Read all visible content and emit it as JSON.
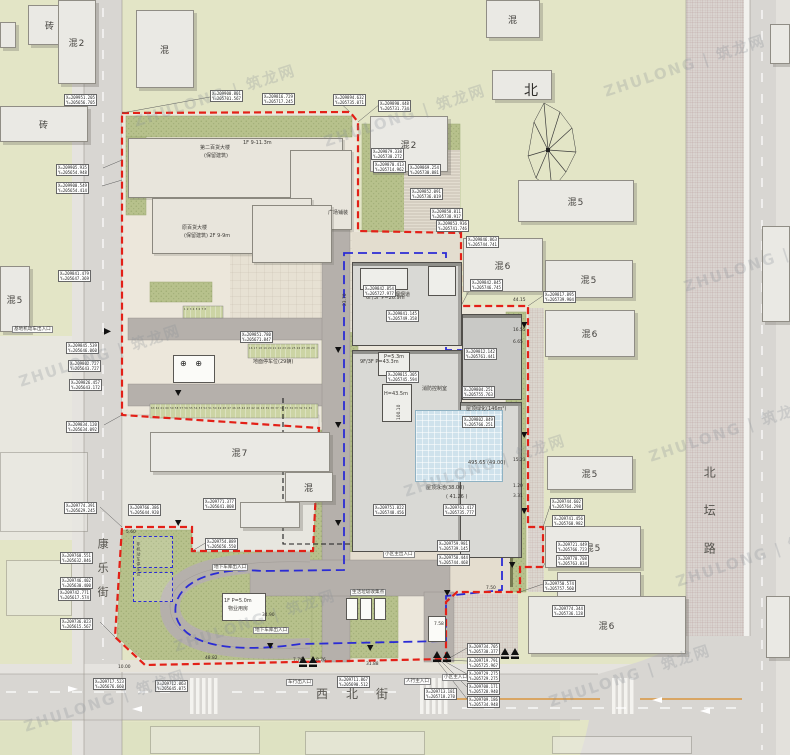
{
  "palette": {
    "boundary_red": "#E32017",
    "garage_blue": "#2B2BD5",
    "site_green": "#B7C18C",
    "road_gray": "#D8D6D2",
    "pool_blue": "#CFE2EC",
    "lawn": "#E3E5C6"
  },
  "compass": {
    "label": "北"
  },
  "streets": {
    "west": "康乐街",
    "south": "西北街",
    "east": "北坛路"
  },
  "watermarks": [
    {
      "x": 130,
      "y": 85,
      "t": "ZHULONG | 筑龙网"
    },
    {
      "x": 15,
      "y": 345,
      "t": "ZHULONG | 筑龙网"
    },
    {
      "x": 400,
      "y": 455,
      "t": "ZHULONG | 筑龙网"
    },
    {
      "x": 600,
      "y": 55,
      "t": "ZHULONG | 筑龙网"
    },
    {
      "x": 645,
      "y": 420,
      "t": "ZHULONG | 筑龙网"
    },
    {
      "x": 170,
      "y": 610,
      "t": "ZHULONG | 筑龙网"
    },
    {
      "x": 545,
      "y": 665,
      "t": "ZHULONG | 筑龙网"
    },
    {
      "x": 20,
      "y": 690,
      "t": "ZHULONG | 筑龙网"
    },
    {
      "x": 680,
      "y": 250,
      "t": "ZHULONG | 筑龙网"
    },
    {
      "x": 672,
      "y": 545,
      "t": "ZHULONG | 筑龙网"
    },
    {
      "x": 320,
      "y": 105,
      "t": "ZHULONG | 筑龙网"
    }
  ],
  "buildings": [
    {
      "x": 28,
      "y": 5,
      "w": 44,
      "h": 40,
      "label": "砖"
    },
    {
      "x": 58,
      "y": 0,
      "w": 38,
      "h": 84,
      "label": "混2"
    },
    {
      "x": 136,
      "y": 10,
      "w": 58,
      "h": 78,
      "label": "混"
    },
    {
      "x": 0,
      "y": 22,
      "w": 16,
      "h": 26,
      "label": ""
    },
    {
      "x": 0,
      "y": 106,
      "w": 88,
      "h": 36,
      "label": "砖"
    },
    {
      "x": 0,
      "y": 266,
      "w": 30,
      "h": 66,
      "label": "混5"
    },
    {
      "x": 0,
      "y": 452,
      "w": 88,
      "h": 80,
      "label": "",
      "cls": "faint"
    },
    {
      "x": 6,
      "y": 560,
      "w": 66,
      "h": 56,
      "label": "",
      "cls": "faint"
    },
    {
      "x": 486,
      "y": 0,
      "w": 54,
      "h": 38,
      "label": "混"
    },
    {
      "x": 370,
      "y": 116,
      "w": 78,
      "h": 56,
      "label": "混2"
    },
    {
      "x": 492,
      "y": 70,
      "w": 60,
      "h": 30,
      "label": ""
    },
    {
      "x": 518,
      "y": 180,
      "w": 116,
      "h": 42,
      "label": "混5"
    },
    {
      "x": 463,
      "y": 238,
      "w": 80,
      "h": 54,
      "label": "混6"
    },
    {
      "x": 545,
      "y": 260,
      "w": 88,
      "h": 38,
      "label": "混5"
    },
    {
      "x": 545,
      "y": 310,
      "w": 90,
      "h": 47,
      "label": "混6"
    },
    {
      "x": 547,
      "y": 456,
      "w": 86,
      "h": 34,
      "label": "混5"
    },
    {
      "x": 545,
      "y": 526,
      "w": 96,
      "h": 42,
      "label": "混5"
    },
    {
      "x": 557,
      "y": 572,
      "w": 84,
      "h": 26,
      "label": ""
    },
    {
      "x": 528,
      "y": 596,
      "w": 158,
      "h": 58,
      "label": "混6"
    },
    {
      "x": 770,
      "y": 24,
      "w": 20,
      "h": 40,
      "label": ""
    },
    {
      "x": 762,
      "y": 226,
      "w": 28,
      "h": 96,
      "label": ""
    },
    {
      "x": 766,
      "y": 596,
      "w": 24,
      "h": 62,
      "label": ""
    },
    {
      "x": 150,
      "y": 726,
      "w": 110,
      "h": 28,
      "label": "",
      "cls": "faint"
    },
    {
      "x": 305,
      "y": 731,
      "w": 120,
      "h": 24,
      "label": "",
      "cls": "faint"
    },
    {
      "x": 552,
      "y": 736,
      "w": 140,
      "h": 18,
      "label": "",
      "cls": "faint"
    },
    {
      "x": 150,
      "y": 432,
      "w": 180,
      "h": 40,
      "label": "混7"
    },
    {
      "x": 285,
      "y": 472,
      "w": 48,
      "h": 30,
      "label": "混"
    },
    {
      "x": 240,
      "y": 502,
      "w": 60,
      "h": 26,
      "label": ""
    },
    {
      "x": 128,
      "y": 138,
      "w": 215,
      "h": 60,
      "label": "",
      "cls": "retained"
    },
    {
      "x": 290,
      "y": 150,
      "w": 62,
      "h": 80,
      "label": "",
      "cls": "retained"
    },
    {
      "x": 152,
      "y": 198,
      "w": 160,
      "h": 56,
      "label": "",
      "cls": "retained"
    },
    {
      "x": 252,
      "y": 205,
      "w": 80,
      "h": 58,
      "label": "",
      "cls": "retained"
    },
    {
      "x": 352,
      "y": 262,
      "w": 110,
      "h": 84,
      "label": "",
      "cls": "new"
    },
    {
      "x": 352,
      "y": 350,
      "w": 110,
      "h": 202,
      "label": "",
      "cls": "new"
    },
    {
      "x": 462,
      "y": 314,
      "w": 60,
      "h": 86,
      "label": "",
      "cls": "newdark"
    },
    {
      "x": 460,
      "y": 402,
      "w": 62,
      "h": 156,
      "label": "",
      "cls": "new"
    },
    {
      "x": 360,
      "y": 268,
      "w": 48,
      "h": 22,
      "label": "",
      "cls": "roofbox"
    },
    {
      "x": 428,
      "y": 266,
      "w": 28,
      "h": 30,
      "label": "",
      "cls": "roofbox"
    },
    {
      "x": 378,
      "y": 352,
      "w": 32,
      "h": 24,
      "label": "",
      "cls": "roofbox"
    },
    {
      "x": 382,
      "y": 384,
      "w": 30,
      "h": 38,
      "label": "",
      "cls": "roofbox"
    },
    {
      "x": 415,
      "y": 410,
      "w": 88,
      "h": 72,
      "label": "",
      "cls": "pool"
    },
    {
      "x": 173,
      "y": 355,
      "w": 42,
      "h": 28,
      "label": "",
      "cls": "white"
    },
    {
      "x": 222,
      "y": 593,
      "w": 44,
      "h": 28,
      "label": "",
      "cls": "white"
    },
    {
      "x": 346,
      "y": 598,
      "w": 12,
      "h": 22,
      "label": "",
      "cls": "white"
    },
    {
      "x": 360,
      "y": 598,
      "w": 12,
      "h": 22,
      "label": "",
      "cls": "white"
    },
    {
      "x": 374,
      "y": 598,
      "w": 12,
      "h": 22,
      "label": "",
      "cls": "white"
    },
    {
      "x": 428,
      "y": 616,
      "w": 18,
      "h": 26,
      "label": "",
      "cls": "white"
    },
    {
      "x": 133,
      "y": 536,
      "w": 40,
      "h": 32,
      "label": "",
      "cls": "bike"
    },
    {
      "x": 133,
      "y": 572,
      "w": 40,
      "h": 30,
      "label": "",
      "cls": "bike"
    }
  ],
  "texts": [
    {
      "x": 96,
      "y": 538,
      "t": "康乐街",
      "cls": "vstreet"
    },
    {
      "x": 316,
      "y": 688,
      "t": "西北街",
      "cls": "hstreet"
    },
    {
      "x": 702,
      "y": 466,
      "t": "北坛路",
      "cls": "vstreet2"
    },
    {
      "x": 524,
      "y": 84,
      "t": "北",
      "cls": "north"
    },
    {
      "x": 200,
      "y": 146,
      "t": "第二百货大楼"
    },
    {
      "x": 204,
      "y": 154,
      "t": "(保留建筑)"
    },
    {
      "x": 243,
      "y": 141,
      "t": "1F 9-11.3m"
    },
    {
      "x": 182,
      "y": 226,
      "t": "原百货大楼"
    },
    {
      "x": 184,
      "y": 234,
      "t": "(保留建筑) 2F 9-9m"
    },
    {
      "x": 366,
      "y": 296,
      "t": "6F/3F  P=26.9m"
    },
    {
      "x": 360,
      "y": 360,
      "t": "9F/3F  P=43.3m"
    },
    {
      "x": 384,
      "y": 392,
      "t": "H=43.5m"
    },
    {
      "x": 384,
      "y": 355,
      "t": "P=5.3m"
    },
    {
      "x": 398,
      "y": 420,
      "t": "100.10",
      "cls": "dimv"
    },
    {
      "x": 344,
      "y": 306,
      "t": "23.70",
      "cls": "dimv"
    },
    {
      "x": 390,
      "y": 293,
      "t": "排烟烟道"
    },
    {
      "x": 422,
      "y": 387,
      "t": "消防控制室"
    },
    {
      "x": 466,
      "y": 407,
      "t": "屋顶绿化(146m²)"
    },
    {
      "x": 426,
      "y": 486,
      "t": "屋顶泳池(38.00)"
    },
    {
      "x": 446,
      "y": 495,
      "t": "( 41.26 )"
    },
    {
      "x": 468,
      "y": 461,
      "t": "495.65 (49.00)"
    },
    {
      "x": 328,
      "y": 211,
      "t": "广场铺装"
    },
    {
      "x": 253,
      "y": 360,
      "t": "地面停车位(29辆)"
    },
    {
      "x": 212,
      "y": 564,
      "t": "地下车库出入口",
      "cls": "tag"
    },
    {
      "x": 253,
      "y": 627,
      "t": "地下车库出入口",
      "cls": "tag"
    },
    {
      "x": 350,
      "y": 589,
      "t": "生活垃圾收集点",
      "cls": "tag"
    },
    {
      "x": 383,
      "y": 551,
      "t": "小区主出入口",
      "cls": "tag"
    },
    {
      "x": 286,
      "y": 679,
      "t": "车行出入口",
      "cls": "tag"
    },
    {
      "x": 404,
      "y": 678,
      "t": "人行主入口",
      "cls": "tag"
    },
    {
      "x": 442,
      "y": 674,
      "t": "小区主入口",
      "cls": "tag"
    },
    {
      "x": 12,
      "y": 326,
      "t": "基地机动车出入口",
      "cls": "tag"
    },
    {
      "x": 224,
      "y": 599,
      "t": "1F P=5.0m"
    },
    {
      "x": 228,
      "y": 607,
      "t": "物业用房"
    },
    {
      "x": 136,
      "y": 542,
      "t": "非机动车停车位",
      "cls": "vtiny"
    },
    {
      "x": 180,
      "y": 360,
      "t": "⊕ ⊕",
      "cls": "sym"
    },
    {
      "x": 249,
      "y": 347,
      "t": "16 17 18 19 20 21 22 23 24 25 26 27 28 29",
      "cls": "stall"
    },
    {
      "x": 151,
      "y": 407,
      "t": "63 62 61 60 59 58 57 56 55 54 53 52 51 50 49 48 47 46 45 44 43 42 41 40 39 38 37 36 35 34 33 32 31 30",
      "cls": "stall"
    },
    {
      "x": 184,
      "y": 308,
      "t": "1 2 3 4 5 6 7 8",
      "cls": "stall"
    },
    {
      "x": 118,
      "y": 666,
      "t": "10.00",
      "cls": "dim"
    },
    {
      "x": 205,
      "y": 657,
      "t": "48.82",
      "cls": "dim"
    },
    {
      "x": 293,
      "y": 659,
      "t": "7.70",
      "cls": "dim"
    },
    {
      "x": 316,
      "y": 659,
      "t": "8.76",
      "cls": "dim"
    },
    {
      "x": 366,
      "y": 663,
      "t": "31.88",
      "cls": "dim"
    },
    {
      "x": 262,
      "y": 614,
      "t": "34.90",
      "cls": "dim"
    },
    {
      "x": 434,
      "y": 623,
      "t": "7.58",
      "cls": "dim"
    },
    {
      "x": 126,
      "y": 531,
      "t": "5.60",
      "cls": "dim"
    },
    {
      "x": 486,
      "y": 587,
      "t": "7.50",
      "cls": "dim"
    },
    {
      "x": 513,
      "y": 299,
      "t": "44.15",
      "cls": "dim"
    },
    {
      "x": 513,
      "y": 329,
      "t": "16.55",
      "cls": "dim"
    },
    {
      "x": 513,
      "y": 341,
      "t": "6.65",
      "cls": "dim"
    },
    {
      "x": 513,
      "y": 459,
      "t": "15.23",
      "cls": "dim"
    },
    {
      "x": 513,
      "y": 485,
      "t": "1.20",
      "cls": "dim"
    },
    {
      "x": 513,
      "y": 495,
      "t": "3.31",
      "cls": "dim"
    }
  ],
  "coord_labels": [
    {
      "x": 64,
      "y": 94,
      "l1": "X=209951.205",
      "l2": "Y=205656.705"
    },
    {
      "x": 56,
      "y": 164,
      "l1": "X=209905.935",
      "l2": "Y=205654.948"
    },
    {
      "x": 56,
      "y": 182,
      "l1": "X=209900.549",
      "l2": "Y=205654.414"
    },
    {
      "x": 210,
      "y": 90,
      "l1": "X=209900.801",
      "l2": "Y=205701.567"
    },
    {
      "x": 262,
      "y": 93,
      "l1": "X=209816.729",
      "l2": "Y=205717.245"
    },
    {
      "x": 333,
      "y": 94,
      "l1": "X=209894.632",
      "l2": "Y=205735.071"
    },
    {
      "x": 378,
      "y": 100,
      "l1": "X=209890.448",
      "l2": "Y=205731.734"
    },
    {
      "x": 371,
      "y": 148,
      "l1": "X=209879.338",
      "l2": "Y=205730.272"
    },
    {
      "x": 373,
      "y": 161,
      "l1": "X=209870.413",
      "l2": "Y=205714.962"
    },
    {
      "x": 408,
      "y": 164,
      "l1": "X=209869.254",
      "l2": "Y=205730.881"
    },
    {
      "x": 410,
      "y": 188,
      "l1": "X=209852.091",
      "l2": "Y=205736.019"
    },
    {
      "x": 430,
      "y": 208,
      "l1": "X=209858.811",
      "l2": "Y=205738.917"
    },
    {
      "x": 436,
      "y": 220,
      "l1": "X=209853.936",
      "l2": "Y=205741.746"
    },
    {
      "x": 466,
      "y": 236,
      "l1": "X=209846.863",
      "l2": "Y=205744.741"
    },
    {
      "x": 470,
      "y": 279,
      "l1": "X=209842.845",
      "l2": "Y=205746.745"
    },
    {
      "x": 543,
      "y": 291,
      "l1": "X=209817.895",
      "l2": "Y=205739.904"
    },
    {
      "x": 363,
      "y": 285,
      "l1": "X=209842.854",
      "l2": "Y=205727.977"
    },
    {
      "x": 386,
      "y": 310,
      "l1": "X=209841.145",
      "l2": "Y=205749.358"
    },
    {
      "x": 386,
      "y": 371,
      "l1": "X=209815.305",
      "l2": "Y=205745.594"
    },
    {
      "x": 464,
      "y": 348,
      "l1": "X=209812.142",
      "l2": "Y=205761.441"
    },
    {
      "x": 462,
      "y": 386,
      "l1": "X=209804.251",
      "l2": "Y=205755.763"
    },
    {
      "x": 462,
      "y": 416,
      "l1": "X=209802.849",
      "l2": "Y=205766.251"
    },
    {
      "x": 58,
      "y": 270,
      "l1": "X=209841.479",
      "l2": "Y=205647.369"
    },
    {
      "x": 66,
      "y": 342,
      "l1": "X=209845.539",
      "l2": "Y=205646.060"
    },
    {
      "x": 68,
      "y": 360,
      "l1": "X=209802.727",
      "l2": "Y=205643.727"
    },
    {
      "x": 69,
      "y": 379,
      "l1": "X=209826.457",
      "l2": "Y=205643.172"
    },
    {
      "x": 66,
      "y": 421,
      "l1": "X=209834.120",
      "l2": "Y=205634.092"
    },
    {
      "x": 64,
      "y": 502,
      "l1": "X=209774.391",
      "l2": "Y=205629.245"
    },
    {
      "x": 60,
      "y": 552,
      "l1": "X=209768.551",
      "l2": "Y=205632.846"
    },
    {
      "x": 60,
      "y": 577,
      "l1": "X=209746.402",
      "l2": "Y=205630.400"
    },
    {
      "x": 58,
      "y": 589,
      "l1": "X=209742.771",
      "l2": "Y=205617.574"
    },
    {
      "x": 60,
      "y": 618,
      "l1": "X=209736.023",
      "l2": "Y=205615.567"
    },
    {
      "x": 128,
      "y": 504,
      "l1": "X=209766.386",
      "l2": "Y=205644.920"
    },
    {
      "x": 203,
      "y": 498,
      "l1": "X=209771.377",
      "l2": "Y=205641.008"
    },
    {
      "x": 205,
      "y": 538,
      "l1": "X=209754.889",
      "l2": "Y=205656.550"
    },
    {
      "x": 240,
      "y": 331,
      "l1": "X=209851.780",
      "l2": "Y=205671.847"
    },
    {
      "x": 373,
      "y": 504,
      "l1": "X=209751.822",
      "l2": "Y=205748.456"
    },
    {
      "x": 443,
      "y": 504,
      "l1": "X=209761.417",
      "l2": "Y=205735.777"
    },
    {
      "x": 437,
      "y": 540,
      "l1": "X=209759.981",
      "l2": "Y=205739.145"
    },
    {
      "x": 437,
      "y": 554,
      "l1": "X=209758.444",
      "l2": "Y=205744.468"
    },
    {
      "x": 93,
      "y": 678,
      "l1": "X=209717.523",
      "l2": "Y=205676.660"
    },
    {
      "x": 155,
      "y": 680,
      "l1": "X=209712.063",
      "l2": "Y=205645.075"
    },
    {
      "x": 337,
      "y": 676,
      "l1": "X=209711.867",
      "l2": "Y=205690.512"
    },
    {
      "x": 424,
      "y": 688,
      "l1": "X=209713.181",
      "l2": "Y=205718.270"
    },
    {
      "x": 467,
      "y": 643,
      "l1": "X=209734.705",
      "l2": "Y=205730.377"
    },
    {
      "x": 467,
      "y": 657,
      "l1": "X=209719.791",
      "l2": "Y=205725.967"
    },
    {
      "x": 467,
      "y": 670,
      "l1": "X=209729.275",
      "l2": "Y=205729.275"
    },
    {
      "x": 467,
      "y": 683,
      "l1": "X=209708.171",
      "l2": "Y=205728.940"
    },
    {
      "x": 467,
      "y": 696,
      "l1": "X=209709.186",
      "l2": "Y=205734.948"
    },
    {
      "x": 550,
      "y": 498,
      "l1": "X=209744.602",
      "l2": "Y=205764.298"
    },
    {
      "x": 552,
      "y": 515,
      "l1": "X=209741.456",
      "l2": "Y=205768.982"
    },
    {
      "x": 556,
      "y": 541,
      "l1": "X=209721.449",
      "l2": "Y=205766.723"
    },
    {
      "x": 556,
      "y": 555,
      "l1": "X=209778.708",
      "l2": "Y=205763.834"
    },
    {
      "x": 543,
      "y": 580,
      "l1": "X=209750.574",
      "l2": "Y=205757.560"
    },
    {
      "x": 552,
      "y": 605,
      "l1": "X=209774.344",
      "l2": "Y=205736.128"
    }
  ]
}
